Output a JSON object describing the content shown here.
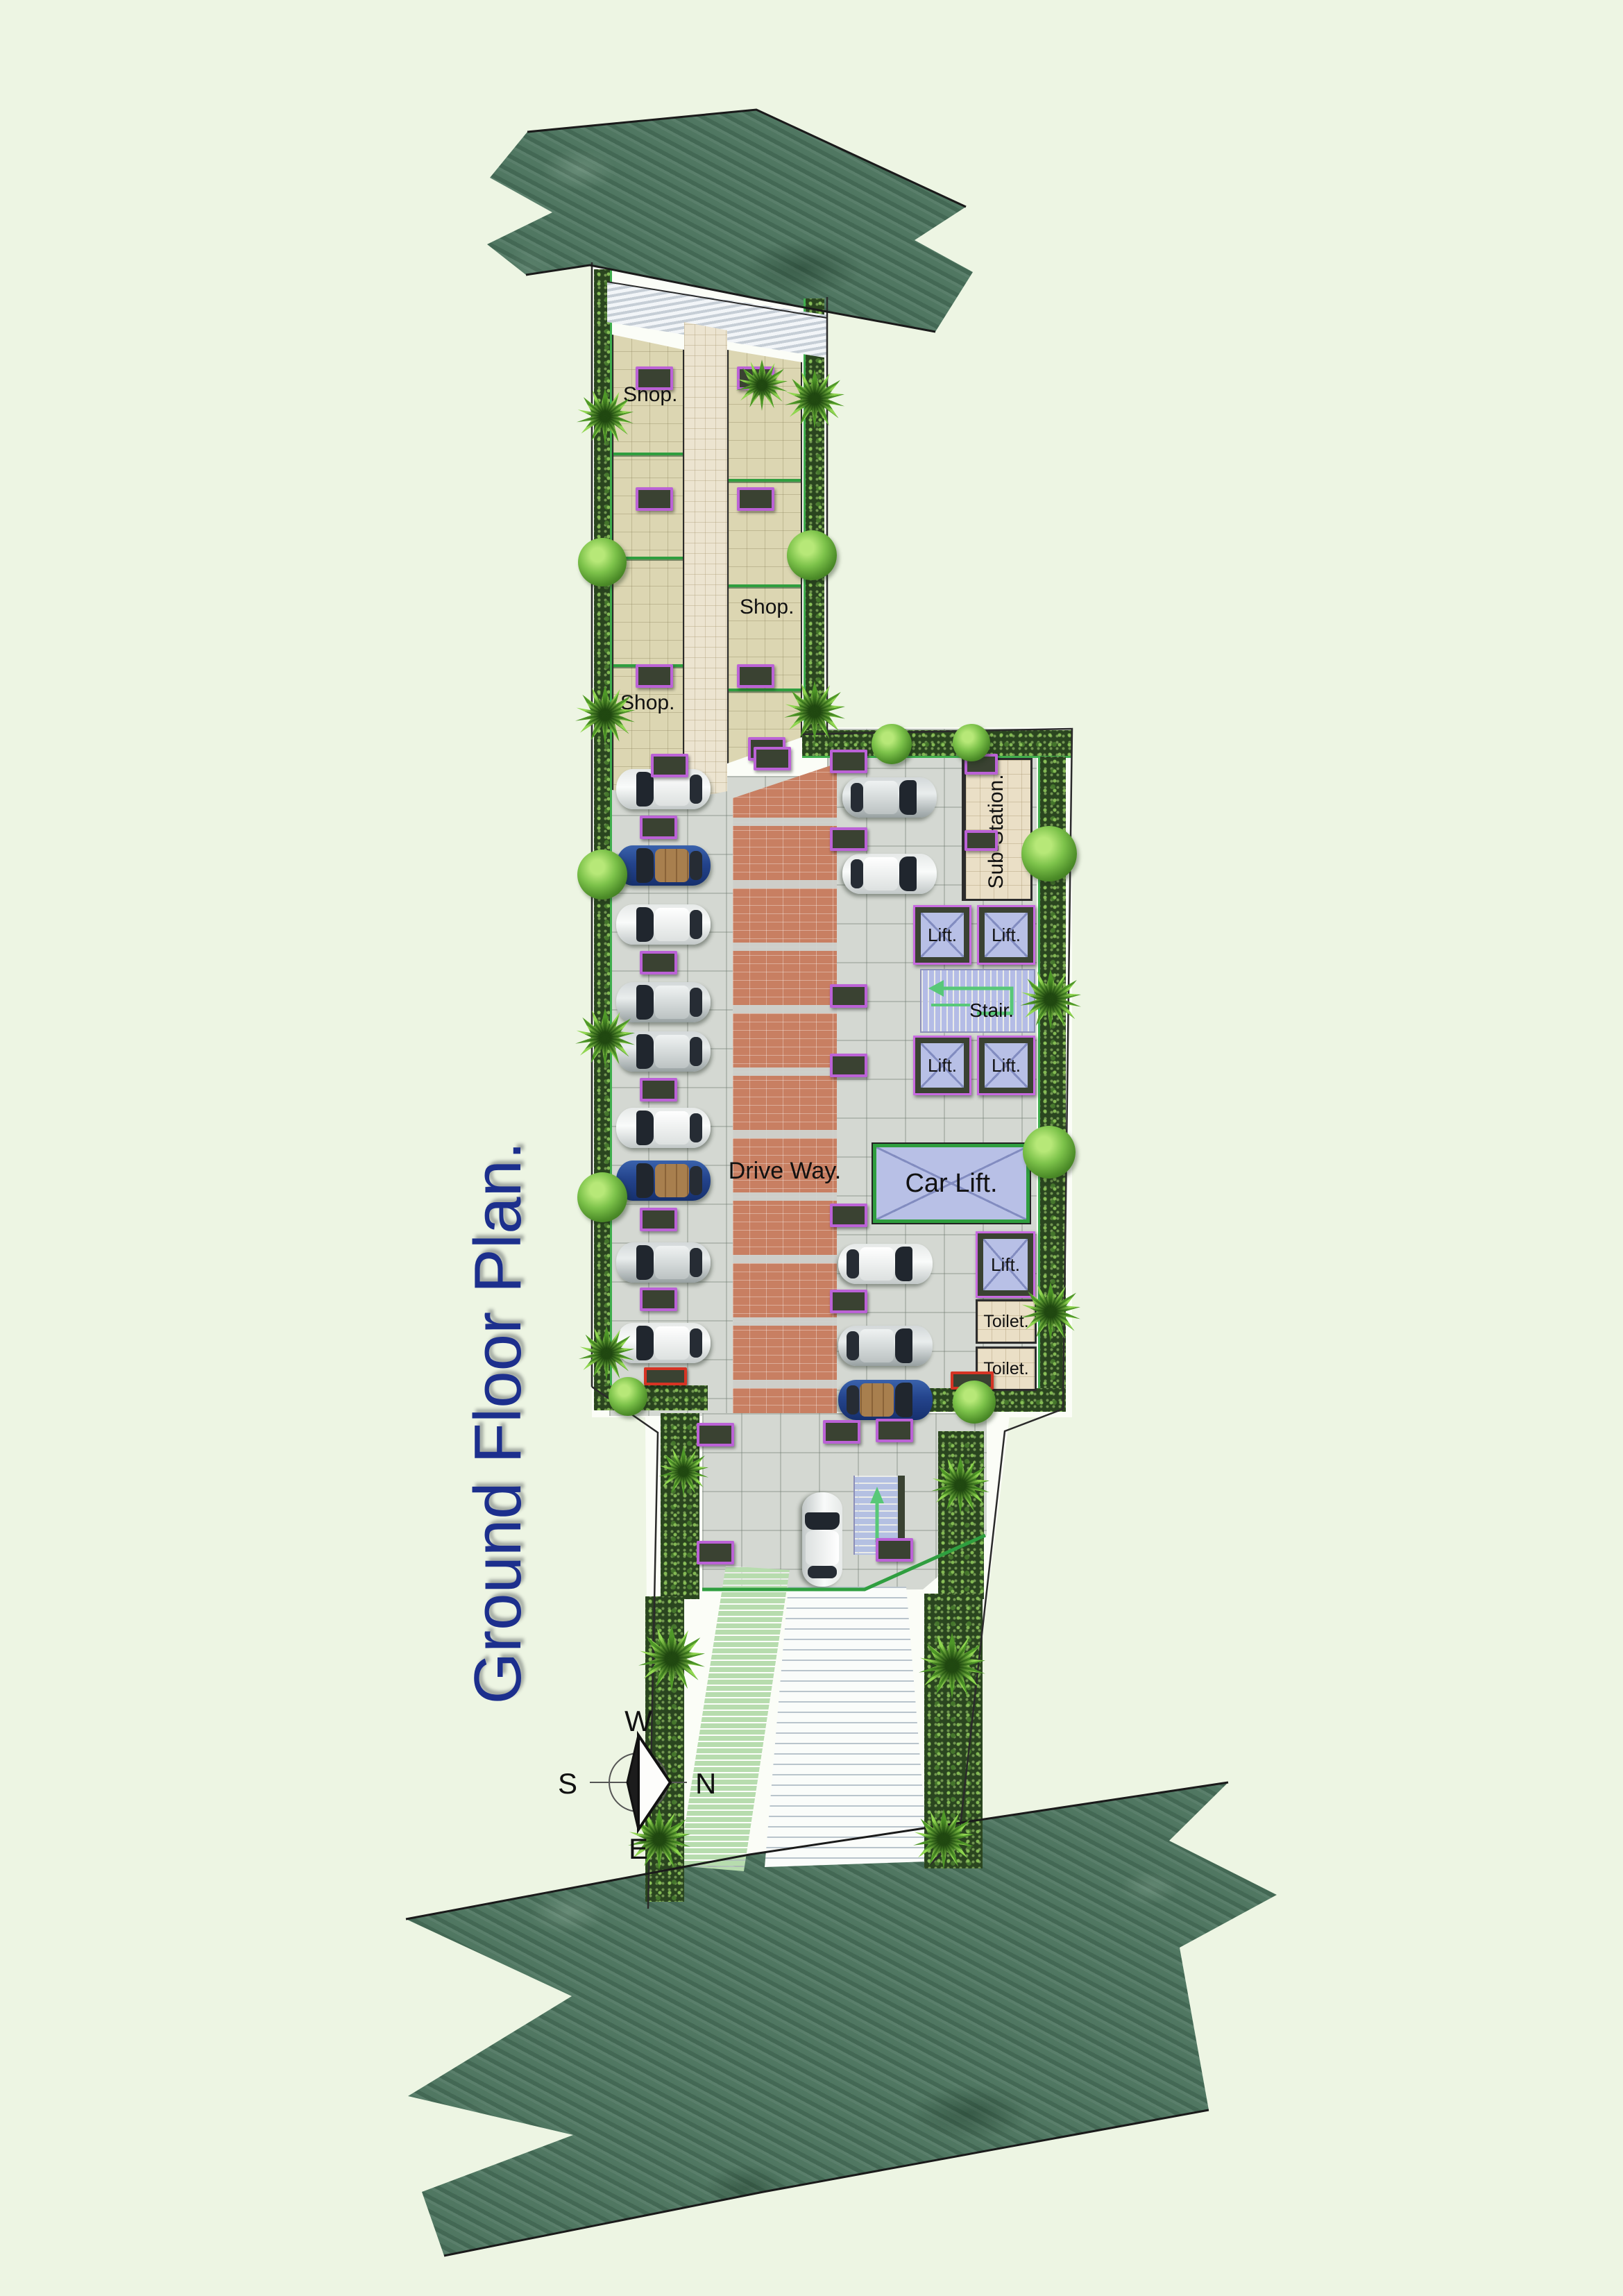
{
  "title": "Ground Floor Plan.",
  "compass": {
    "top": "W",
    "right": "N",
    "bottom": "E",
    "left": "S"
  },
  "rooms": {
    "shop": "Shop.",
    "sub_station": "Sub-Station.",
    "lift": "Lift.",
    "stair": "Stair.",
    "car_lift": "Car Lift.",
    "drive_way": "Drive Way.",
    "toilet": "Toilet."
  },
  "parking": {
    "left_column_cars": [
      "white",
      "blue",
      "white",
      "silver",
      "silver",
      "white",
      "blue",
      "silver",
      "white"
    ],
    "right_upper_cars": [
      "silver",
      "white"
    ],
    "right_lower_cars": [
      "white",
      "silver",
      "blue"
    ],
    "entrance_cars": [
      "white"
    ],
    "total_cars": 15
  },
  "colors": {
    "background": "#edf5e3",
    "road_marble_green": "#4e7560",
    "title_text": "#1c2f8d",
    "shop_floor": "#dcd6b2",
    "corridor_floor": "#ece4d0",
    "parking_floor": "#d4d8d2",
    "driveway_brick": "#c87f62",
    "lift_cab": "#b8c0e6",
    "wall_dark": "#3a4232",
    "door_marker_outline": "#bb62d6",
    "exit_marker_outline": "#d63424",
    "partition_green": "#2f9e3f",
    "hedge_green": "#2a451f",
    "ramp_green": "#b7dcae"
  }
}
